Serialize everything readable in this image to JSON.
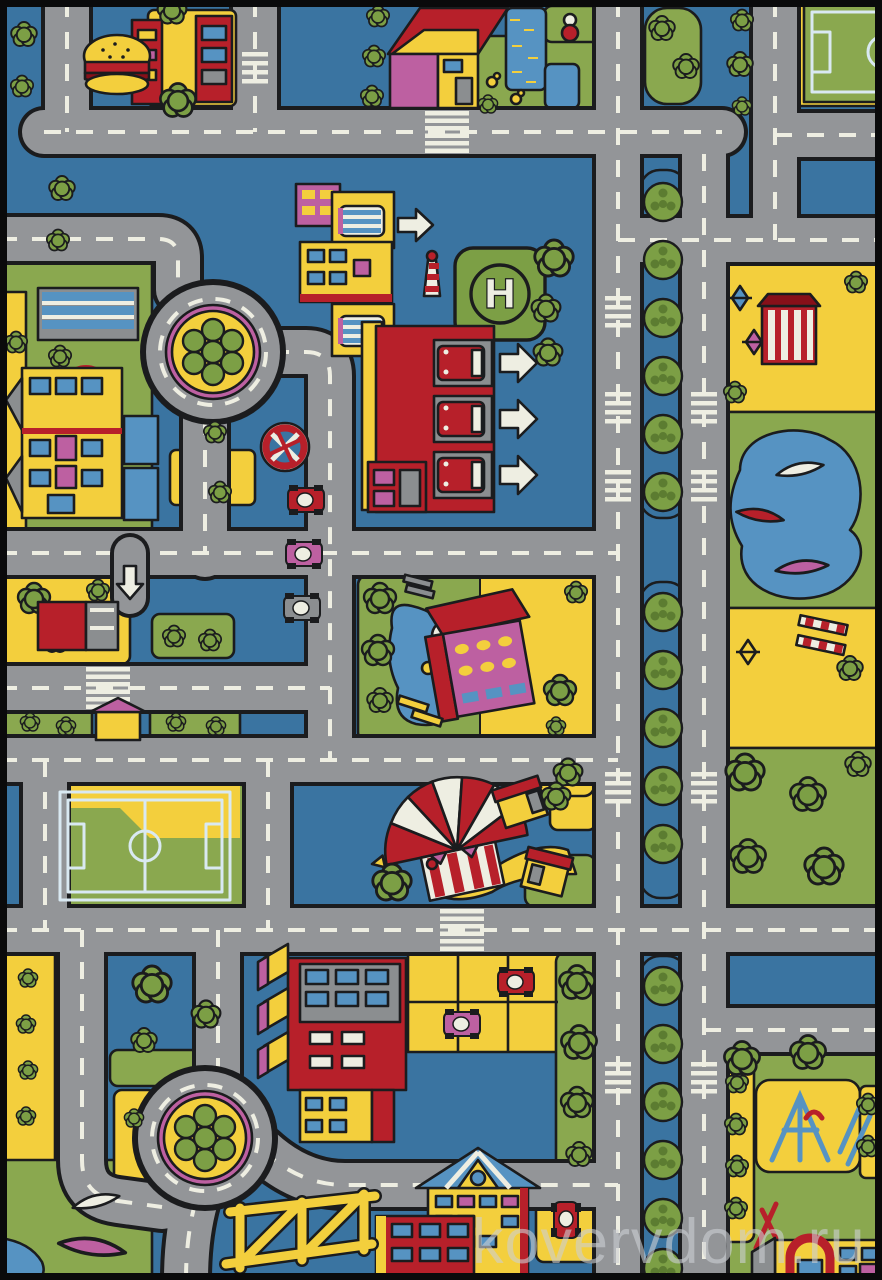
{
  "watermark": {
    "text": "kovervdom.ru",
    "color": "#cdd0d4"
  },
  "helipad": {
    "label": "H"
  },
  "palette": {
    "blue": "#3a74a1",
    "road": "#939598",
    "white": "#eeeee2",
    "outline": "#1b1c1e",
    "yellow": "#f3cf3d",
    "green": "#8aa84f",
    "tree": "#7c9f45",
    "treedark": "#5c7c31",
    "red": "#b7202a",
    "darkred": "#871019",
    "magenta": "#bd60a1",
    "pond": "#5693c2",
    "gray": "#8b8e90"
  },
  "scene": {
    "subject": "children city-roads play rug",
    "landmarks": [
      "hamburger-restaurant",
      "farm-house-garden",
      "soccer-field-top-right",
      "toy-park",
      "school-building",
      "roundabout-top",
      "roundabout-bottom",
      "bus-depot",
      "fire-station",
      "helipad",
      "lighthouse",
      "no-stopping-sign",
      "parked-cars",
      "garage",
      "pink-villa",
      "soccer-field-bottom-left",
      "circus-tent",
      "apartment-block",
      "parking-lot",
      "construction-frame",
      "playground",
      "boulevard-tree-median",
      "boat-pond"
    ]
  }
}
